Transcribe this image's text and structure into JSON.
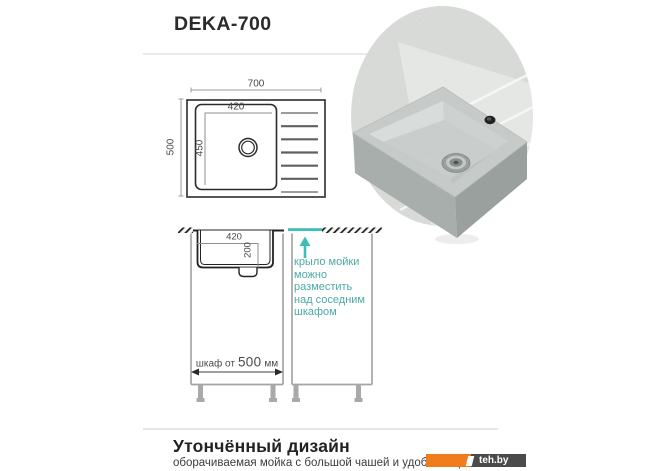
{
  "header": {
    "title": "DEKA-700"
  },
  "top_view": {
    "overall_width": "700",
    "overall_height": "500",
    "bowl_width": "420",
    "bowl_height": "450"
  },
  "side_view": {
    "bowl_width": "420",
    "bowl_depth": "200",
    "cabinet_prefix": "шкаф от",
    "cabinet_value": "500",
    "cabinet_suffix": "мм"
  },
  "note": {
    "lines": [
      "крыло мойки",
      "можно",
      "разместить",
      "над соседним",
      "шкафом"
    ]
  },
  "footer": {
    "heading": "Утончённый дизайн",
    "subtext": "оборачиваемая мойка с большой чашей и удобным крылом"
  },
  "watermark": {
    "label": "teh.by"
  },
  "colors": {
    "teal_accent": "#3fbdb9",
    "teal_text": "#4baaa7",
    "watermark_orange": "#f07c1e",
    "watermark_dark": "#4b4b4b",
    "outline_dark": "#2b2b2b",
    "cabinet_gray": "#a4a4a4"
  }
}
